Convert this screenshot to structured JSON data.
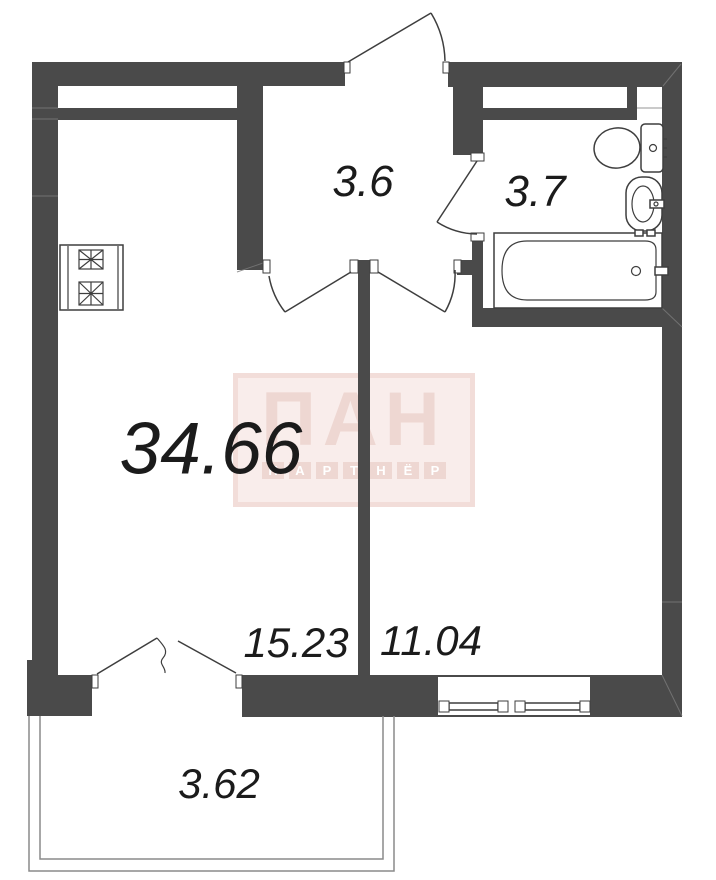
{
  "plan": {
    "kind": "apartment-floor-plan",
    "rooms": [
      {
        "id": "kitchen-living",
        "area": "34.66"
      },
      {
        "id": "living-zone",
        "area": "15.23"
      },
      {
        "id": "bedroom",
        "area": "11.04"
      },
      {
        "id": "hallway",
        "area": "3.6"
      },
      {
        "id": "bathroom",
        "area": "3.7"
      },
      {
        "id": "balcony",
        "area": "3.62"
      }
    ],
    "fixtures": [
      "stove-icon",
      "toilet-icon",
      "sink-icon",
      "bathtub-icon",
      "window-symbol",
      "door-swing-symbols"
    ]
  },
  "watermark": {
    "brand": "ПАН",
    "subtitle": "ПАРТНЁР",
    "letters": [
      "П",
      "А",
      "Р",
      "Т",
      "Н",
      "Ё",
      "Р"
    ]
  },
  "colors": {
    "wall": "#4a4a4a",
    "line": "#3e3e3e",
    "joint": "#7a7a7a",
    "balcony_line": "#8a8a8a",
    "text": "#1b1b1b",
    "watermark_bg": "#f9edeb",
    "watermark_border": "#f2ddd9",
    "watermark_letter": "#eed7d2",
    "watermark_text": "#ffffff"
  }
}
